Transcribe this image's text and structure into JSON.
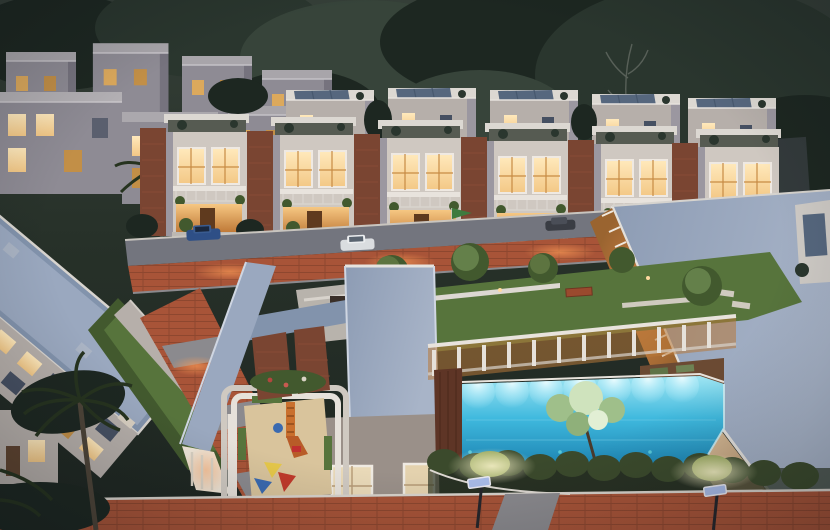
{
  "scene": {
    "type": "aerial-architectural-render",
    "time_of_day": "dusk",
    "elements": [
      "dusk-sky",
      "tree-canopy",
      "distant-building",
      "villa-row-back",
      "villa-row-middle",
      "villa-row-front",
      "front-street",
      "parked-cars",
      "flag",
      "clubhouse-right",
      "louver-wall",
      "apartment-left",
      "left-street",
      "courtyard-lawn",
      "garden-benches",
      "pergola-walkway",
      "walkway-roof",
      "amphitheater",
      "tower-roof",
      "skylight-roof",
      "playground",
      "play-slide",
      "toy-tents",
      "swimming-pool",
      "pool-lights",
      "overhang-tree",
      "wood-deck",
      "hedge-row",
      "boundary-road",
      "street-lamps",
      "palm-tree"
    ]
  },
  "palette": {
    "sky_top": "#353f38",
    "sky_mid": "#273129",
    "sky_bottom": "#1e2621",
    "tree_dark": "#1d2721",
    "tree_mid": "#2a362e",
    "tree_soft": "#37443a",
    "wall_light": "#cfc8c1",
    "wall_mid": "#b6afaa",
    "wall_shadow": "#9b97a0",
    "wall_far": "#8e8b94",
    "roof_slab": "#dcd8d2",
    "roof_blue": "#9aa8bf",
    "roof_blue_dark": "#8293ac",
    "roof_warm_gray": "#9a9089",
    "solar_panel": "#56677e",
    "brick": "#7a4532",
    "brick_light": "#96583d",
    "window_warm": "#f3c886",
    "window_bright": "#ffe9bc",
    "window_dusk": "#465062",
    "veranda_glow": "#e9b266",
    "louver_warm": "#dd9a4c",
    "road_terracotta": "#a85438",
    "road_red_dark": "#84432e",
    "paver_gray": "#8b8a8e",
    "drive_gray": "#73757e",
    "lawn": "#57743c",
    "lawn_dark": "#42592e",
    "lawn_lit": "#7c9a50",
    "pool_light": "#9fe5f2",
    "pool_mid": "#3fb9de",
    "pool_deep": "#1a7fae",
    "hedge_dark": "#3b4a2c",
    "hedge_lit": "#96a65c",
    "sand": "#d9c49c",
    "slide_orange": "#c9702e",
    "toy_red": "#c0392b",
    "toy_yellow": "#e6c84a",
    "toy_blue": "#3a6ab0",
    "wood_deck": "#6b4a33",
    "deck_red": "#5e3526",
    "lamp_panel": "#a9bce8",
    "lamp_glow": "#f2edc4",
    "curb_light": "#d8d3cc",
    "cream_wall": "#e0ccae",
    "car_blue": "#2e4f86",
    "car_white": "#dadde0",
    "car_dark": "#3a3d44",
    "flag_green": "#3e7a3e",
    "palm_dark": "#26331f",
    "palm_trunk": "#4d4438"
  }
}
